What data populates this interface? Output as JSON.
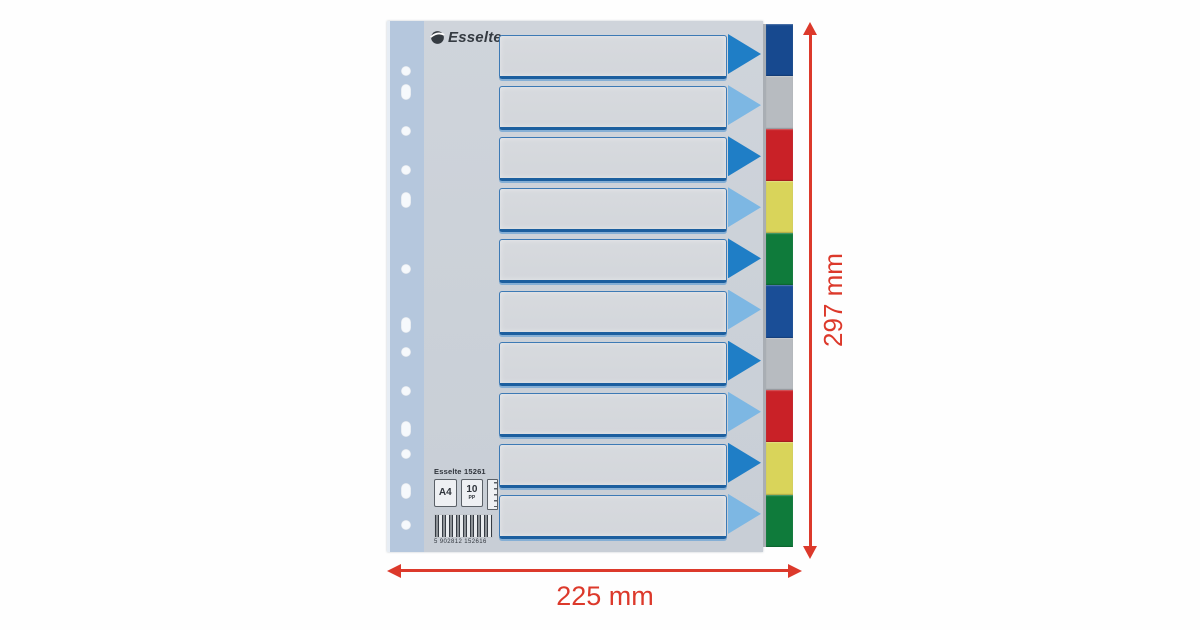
{
  "product": {
    "brand": "Esselte",
    "logo_text": "Esselte",
    "info_line": "Esselte 15261",
    "format_badge": "A4",
    "count_badge": "10",
    "count_unit": "PP",
    "barcode_digits": "5 902812 152616",
    "label_field_count": 10,
    "arrow_colors": {
      "dark": "#1f7ec6",
      "light": "#7db7e3"
    },
    "tabs": [
      {
        "name": "blue",
        "color": "#17498f"
      },
      {
        "name": "grey",
        "color": "#b7bbc0"
      },
      {
        "name": "red",
        "color": "#c92127"
      },
      {
        "name": "yellow",
        "color": "#d9d45a"
      },
      {
        "name": "green",
        "color": "#0f7b3b"
      },
      {
        "name": "blue-2",
        "color": "#1a4e97"
      },
      {
        "name": "grey-2",
        "color": "#b7bbc0"
      },
      {
        "name": "red-2",
        "color": "#c92127"
      },
      {
        "name": "yellow-2",
        "color": "#d9d45a"
      },
      {
        "name": "green-2",
        "color": "#0f7b3b"
      }
    ]
  },
  "dimensions": {
    "height_label": "297 mm",
    "width_label": "225 mm",
    "annotation_color": "#dc392b"
  }
}
